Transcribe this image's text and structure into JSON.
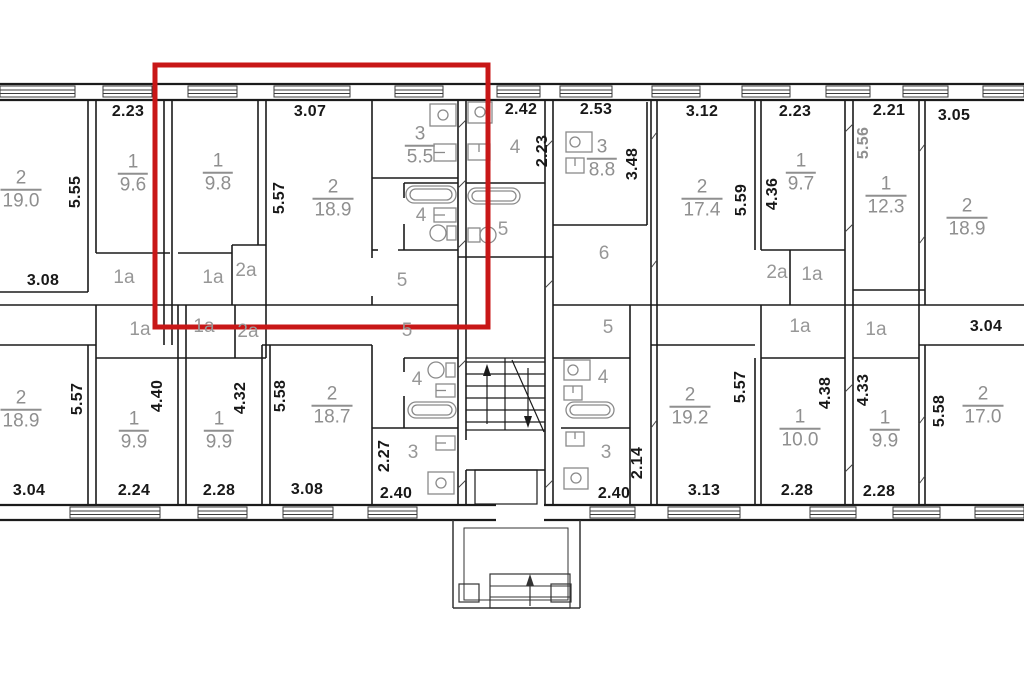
{
  "document_type": "apartment-building-floor-plan",
  "colors": {
    "wall": "#1b1b1b",
    "dimension_text": "#181818",
    "gray_text": "#8f8f8f",
    "fixture_outline": "#8a8a8a",
    "highlight_red": "#c81717",
    "background": "#ffffff"
  },
  "highlight": {
    "x": 155,
    "y": 65,
    "width": 333,
    "height": 262
  },
  "icons": [
    "stove-icon",
    "sink-icon",
    "bathtub-icon",
    "toilet-icon",
    "window-glyph",
    "stairs-up-arrow-icon",
    "stairs-down-arrow-icon",
    "entrance-steps-icon"
  ],
  "labels": [
    {
      "name": "dim-label",
      "style": "dim",
      "text": "2.23",
      "x": 128,
      "y": 112
    },
    {
      "name": "dim-label",
      "style": "dim",
      "text": "3.07",
      "x": 310,
      "y": 112
    },
    {
      "name": "dim-label",
      "style": "dim",
      "text": "2.42",
      "x": 521,
      "y": 110
    },
    {
      "name": "dim-label",
      "style": "dim",
      "text": "2.53",
      "x": 596,
      "y": 110
    },
    {
      "name": "dim-label",
      "style": "dim",
      "text": "3.12",
      "x": 702,
      "y": 112
    },
    {
      "name": "dim-label",
      "style": "dim",
      "text": "2.23",
      "x": 795,
      "y": 112
    },
    {
      "name": "dim-label",
      "style": "dim",
      "text": "2.21",
      "x": 889,
      "y": 111
    },
    {
      "name": "dim-label",
      "style": "dim",
      "text": "3.05",
      "x": 954,
      "y": 116
    },
    {
      "name": "dim-label",
      "style": "dim",
      "text": "3.08",
      "x": 43,
      "y": 281
    },
    {
      "name": "dim-label",
      "style": "dim",
      "text": "3.04",
      "x": 986,
      "y": 327
    },
    {
      "name": "dim-label",
      "style": "dim",
      "text": "3.04",
      "x": 29,
      "y": 491
    },
    {
      "name": "dim-label",
      "style": "dim",
      "text": "2.24",
      "x": 134,
      "y": 491
    },
    {
      "name": "dim-label",
      "style": "dim",
      "text": "2.28",
      "x": 219,
      "y": 491
    },
    {
      "name": "dim-label",
      "style": "dim",
      "text": "3.08",
      "x": 307,
      "y": 490
    },
    {
      "name": "dim-label",
      "style": "dim",
      "text": "2.40",
      "x": 396,
      "y": 494
    },
    {
      "name": "dim-label",
      "style": "dim",
      "text": "2.40",
      "x": 614,
      "y": 494
    },
    {
      "name": "dim-label",
      "style": "dim",
      "text": "3.13",
      "x": 704,
      "y": 491
    },
    {
      "name": "dim-label",
      "style": "dim",
      "text": "2.28",
      "x": 797,
      "y": 491
    },
    {
      "name": "dim-label",
      "style": "dim",
      "text": "2.28",
      "x": 879,
      "y": 492
    },
    {
      "name": "dim-label",
      "style": "dimv",
      "text": "5.55",
      "x": 76,
      "y": 192
    },
    {
      "name": "dim-label",
      "style": "dimv",
      "text": "5.57",
      "x": 280,
      "y": 198
    },
    {
      "name": "dim-label",
      "style": "dimv",
      "text": "2.23",
      "x": 543,
      "y": 151
    },
    {
      "name": "dim-label",
      "style": "dimv",
      "text": "3.48",
      "x": 633,
      "y": 164
    },
    {
      "name": "dim-label",
      "style": "dimv",
      "text": "5.59",
      "x": 742,
      "y": 200
    },
    {
      "name": "dim-label",
      "style": "dimv",
      "text": "4.36",
      "x": 773,
      "y": 194
    },
    {
      "name": "dim-label",
      "style": "dimvg",
      "text": "5.56",
      "x": 864,
      "y": 143
    },
    {
      "name": "dim-label",
      "style": "dimv",
      "text": "5.57",
      "x": 78,
      "y": 399
    },
    {
      "name": "dim-label",
      "style": "dimv",
      "text": "4.40",
      "x": 158,
      "y": 396
    },
    {
      "name": "dim-label",
      "style": "dimv",
      "text": "4.32",
      "x": 241,
      "y": 398
    },
    {
      "name": "dim-label",
      "style": "dimv",
      "text": "5.58",
      "x": 281,
      "y": 396
    },
    {
      "name": "dim-label",
      "style": "dimv",
      "text": "2.27",
      "x": 385,
      "y": 456
    },
    {
      "name": "dim-label",
      "style": "dimv",
      "text": "2.14",
      "x": 638,
      "y": 463
    },
    {
      "name": "dim-label",
      "style": "dimv",
      "text": "5.57",
      "x": 741,
      "y": 387
    },
    {
      "name": "dim-label",
      "style": "dimv",
      "text": "4.38",
      "x": 826,
      "y": 393
    },
    {
      "name": "dim-label",
      "style": "dimv",
      "text": "4.33",
      "x": 864,
      "y": 390
    },
    {
      "name": "dim-label",
      "style": "dimv",
      "text": "5.58",
      "x": 940,
      "y": 411
    },
    {
      "name": "room-area-label",
      "style": "room",
      "num": "2",
      "area": "19.0",
      "x": 21,
      "y": 190
    },
    {
      "name": "room-area-label",
      "style": "room",
      "num": "1",
      "area": "9.6",
      "x": 133,
      "y": 174
    },
    {
      "name": "room-area-label",
      "style": "room",
      "num": "1",
      "area": "9.8",
      "x": 218,
      "y": 173
    },
    {
      "name": "room-area-label",
      "style": "room",
      "num": "2",
      "area": "18.9",
      "x": 333,
      "y": 199
    },
    {
      "name": "room-area-label",
      "style": "room",
      "num": "3",
      "area": "5.5",
      "x": 420,
      "y": 146
    },
    {
      "name": "room-area-label",
      "style": "room",
      "num": "3",
      "area": "8.8",
      "x": 602,
      "y": 159
    },
    {
      "name": "room-area-label",
      "style": "room",
      "num": "2",
      "area": "17.4",
      "x": 702,
      "y": 199
    },
    {
      "name": "room-area-label",
      "style": "room",
      "num": "1",
      "area": "9.7",
      "x": 801,
      "y": 173
    },
    {
      "name": "room-area-label",
      "style": "room",
      "num": "1",
      "area": "12.3",
      "x": 886,
      "y": 196
    },
    {
      "name": "room-area-label",
      "style": "room",
      "num": "2",
      "area": "18.9",
      "x": 967,
      "y": 218
    },
    {
      "name": "room-area-label",
      "style": "room",
      "num": "2",
      "area": "18.9",
      "x": 21,
      "y": 410
    },
    {
      "name": "room-area-label",
      "style": "room",
      "num": "1",
      "area": "9.9",
      "x": 134,
      "y": 431
    },
    {
      "name": "room-area-label",
      "style": "room",
      "num": "1",
      "area": "9.9",
      "x": 219,
      "y": 431
    },
    {
      "name": "room-area-label",
      "style": "room",
      "num": "2",
      "area": "18.7",
      "x": 332,
      "y": 406
    },
    {
      "name": "room-area-label",
      "style": "room",
      "num": "2",
      "area": "19.2",
      "x": 690,
      "y": 407
    },
    {
      "name": "room-area-label",
      "style": "room",
      "num": "1",
      "area": "10.0",
      "x": 800,
      "y": 429
    },
    {
      "name": "room-area-label",
      "style": "room",
      "num": "1",
      "area": "9.9",
      "x": 885,
      "y": 430
    },
    {
      "name": "room-area-label",
      "style": "room",
      "num": "2",
      "area": "17.0",
      "x": 983,
      "y": 406
    },
    {
      "name": "room-tag",
      "style": "tag",
      "text": "1a",
      "x": 124,
      "y": 278
    },
    {
      "name": "room-tag",
      "style": "tag",
      "text": "1a",
      "x": 213,
      "y": 278
    },
    {
      "name": "room-tag",
      "style": "tag",
      "text": "2a",
      "x": 246,
      "y": 271
    },
    {
      "name": "room-tag",
      "style": "tag",
      "text": "2a",
      "x": 777,
      "y": 273
    },
    {
      "name": "room-tag",
      "style": "tag",
      "text": "1a",
      "x": 812,
      "y": 275
    },
    {
      "name": "room-tag",
      "style": "tag",
      "text": "1a",
      "x": 140,
      "y": 330
    },
    {
      "name": "room-tag",
      "style": "tag",
      "text": "1a",
      "x": 204,
      "y": 327
    },
    {
      "name": "room-tag",
      "style": "tag",
      "text": "2a",
      "x": 248,
      "y": 332
    },
    {
      "name": "room-tag",
      "style": "tag",
      "text": "1a",
      "x": 800,
      "y": 327
    },
    {
      "name": "room-tag",
      "style": "tag",
      "text": "1a",
      "x": 876,
      "y": 330
    },
    {
      "name": "room-tag",
      "style": "tag",
      "text": "4",
      "x": 421,
      "y": 216
    },
    {
      "name": "room-tag",
      "style": "tag",
      "text": "4",
      "x": 515,
      "y": 148
    },
    {
      "name": "room-tag",
      "style": "tag",
      "text": "4",
      "x": 417,
      "y": 380
    },
    {
      "name": "room-tag",
      "style": "tag",
      "text": "4",
      "x": 603,
      "y": 378
    },
    {
      "name": "room-tag",
      "style": "tag",
      "text": "5",
      "x": 402,
      "y": 281
    },
    {
      "name": "room-tag",
      "style": "tag",
      "text": "5",
      "x": 503,
      "y": 230
    },
    {
      "name": "room-tag",
      "style": "tag",
      "text": "5",
      "x": 407,
      "y": 331
    },
    {
      "name": "room-tag",
      "style": "tag",
      "text": "5",
      "x": 608,
      "y": 328
    },
    {
      "name": "room-tag",
      "style": "tag",
      "text": "3",
      "x": 413,
      "y": 453
    },
    {
      "name": "room-tag",
      "style": "tag",
      "text": "3",
      "x": 606,
      "y": 453
    },
    {
      "name": "room-tag",
      "style": "tag",
      "text": "6",
      "x": 604,
      "y": 254
    }
  ]
}
